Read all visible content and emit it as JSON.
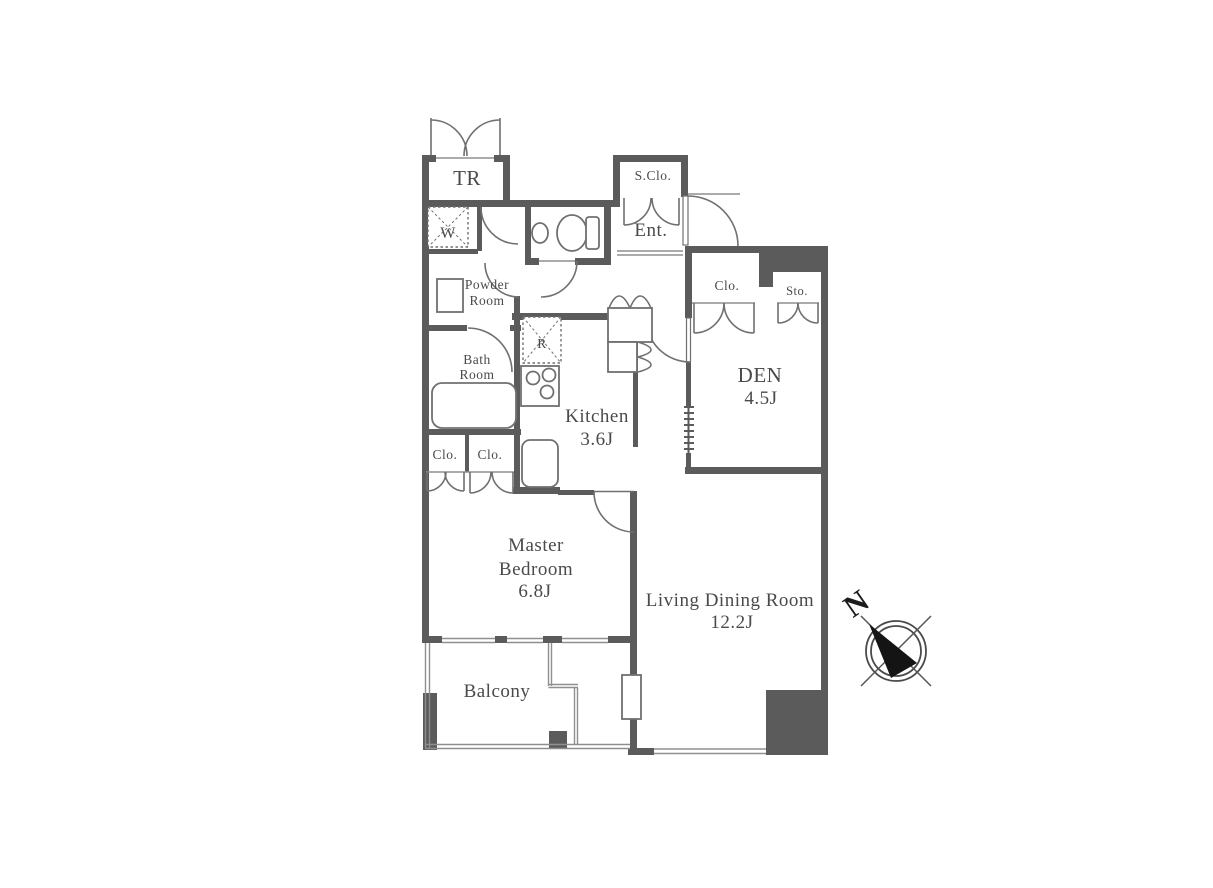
{
  "floorplan": {
    "rooms": {
      "trunk": {
        "label": "TR"
      },
      "washer": {
        "label": "W"
      },
      "shoe_closet": {
        "label": "S.Clo."
      },
      "entrance": {
        "label": "Ent."
      },
      "powder_room": {
        "line1": "Powder",
        "line2": "Room"
      },
      "bath_room": {
        "line1": "Bath",
        "line2": "Room"
      },
      "refrigerator": {
        "label": "R"
      },
      "kitchen": {
        "name": "Kitchen",
        "area": "3.6J"
      },
      "closet_left_1": {
        "label": "Clo."
      },
      "closet_left_2": {
        "label": "Clo."
      },
      "closet_den": {
        "label": "Clo."
      },
      "storage": {
        "label": "Sto."
      },
      "den": {
        "name": "DEN",
        "area": "4.5J"
      },
      "master_bedroom": {
        "line1": "Master",
        "line2": "Bedroom",
        "area": "6.8J"
      },
      "living_dining": {
        "name": "Living Dining Room",
        "area": "12.2J"
      },
      "balcony": {
        "label": "Balcony"
      }
    },
    "compass": {
      "label": "N"
    },
    "colors": {
      "wall": "#5b5b5b",
      "line": "#707070",
      "thin": "#8f8f8f",
      "text": "#4a4a4a"
    }
  }
}
